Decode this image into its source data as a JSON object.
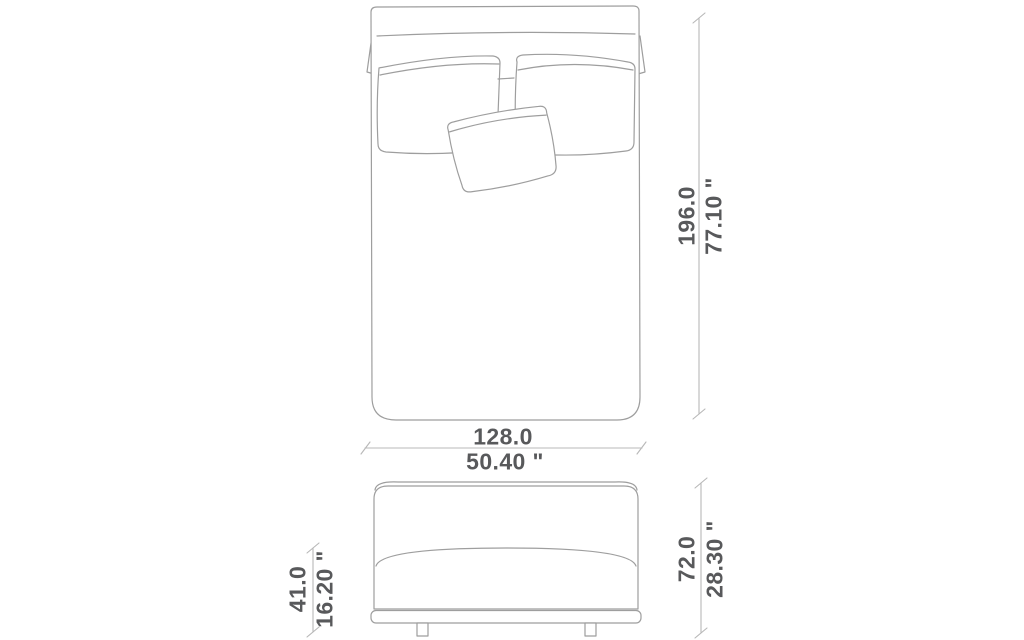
{
  "colors": {
    "background": "#ffffff",
    "text": "#58595b",
    "drawing_line": "#9e9e9e",
    "dimension_line": "#b8b8b8"
  },
  "top_view": {
    "length": {
      "metric": "196.0",
      "imperial": "77.10 \""
    },
    "width": {
      "metric": "128.0",
      "imperial": "50.40 \""
    }
  },
  "front_view": {
    "height": {
      "metric": "72.0",
      "imperial": "28.30 \""
    },
    "base_height": {
      "metric": "41.0",
      "imperial": "16.20 \""
    }
  }
}
